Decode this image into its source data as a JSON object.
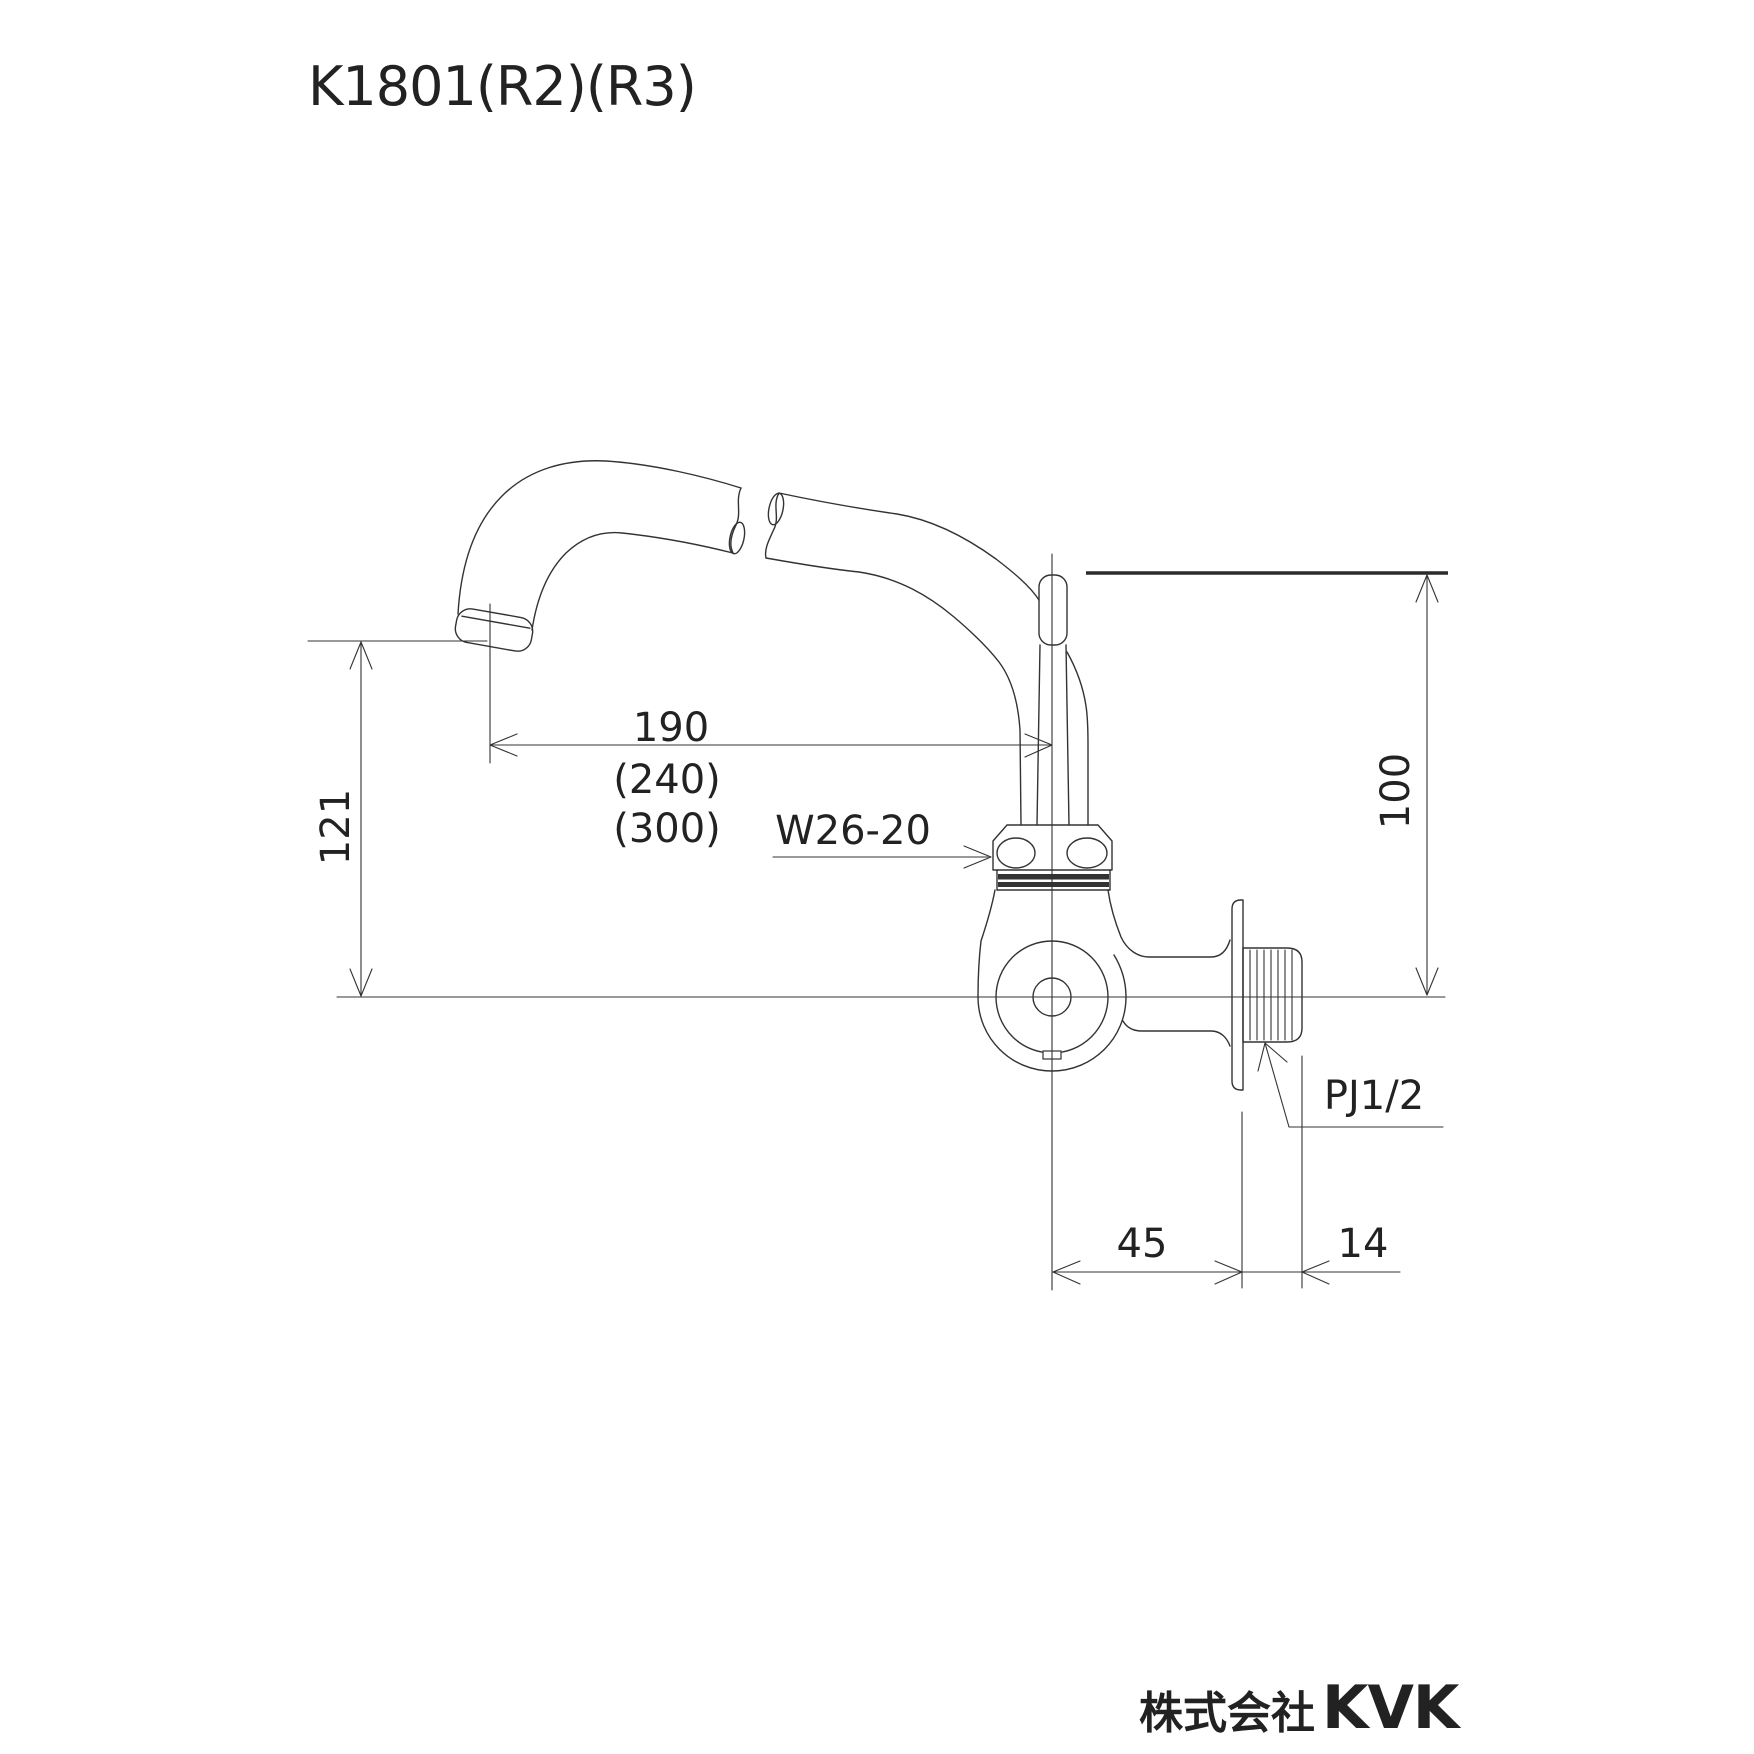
{
  "title": "K1801(R2)(R3)",
  "dimensions": {
    "spout_reach": "190",
    "spout_reach_alt_r2": "(240)",
    "spout_reach_alt_r3": "(300)",
    "spout_height": "121",
    "top_to_center": "100",
    "center_to_wall": "45",
    "thread_length": "14"
  },
  "labels": {
    "spout_nut_thread": "W26-20",
    "inlet_thread": "PJ1/2"
  },
  "footer": {
    "company": "株式会社",
    "brand": "KVK"
  }
}
